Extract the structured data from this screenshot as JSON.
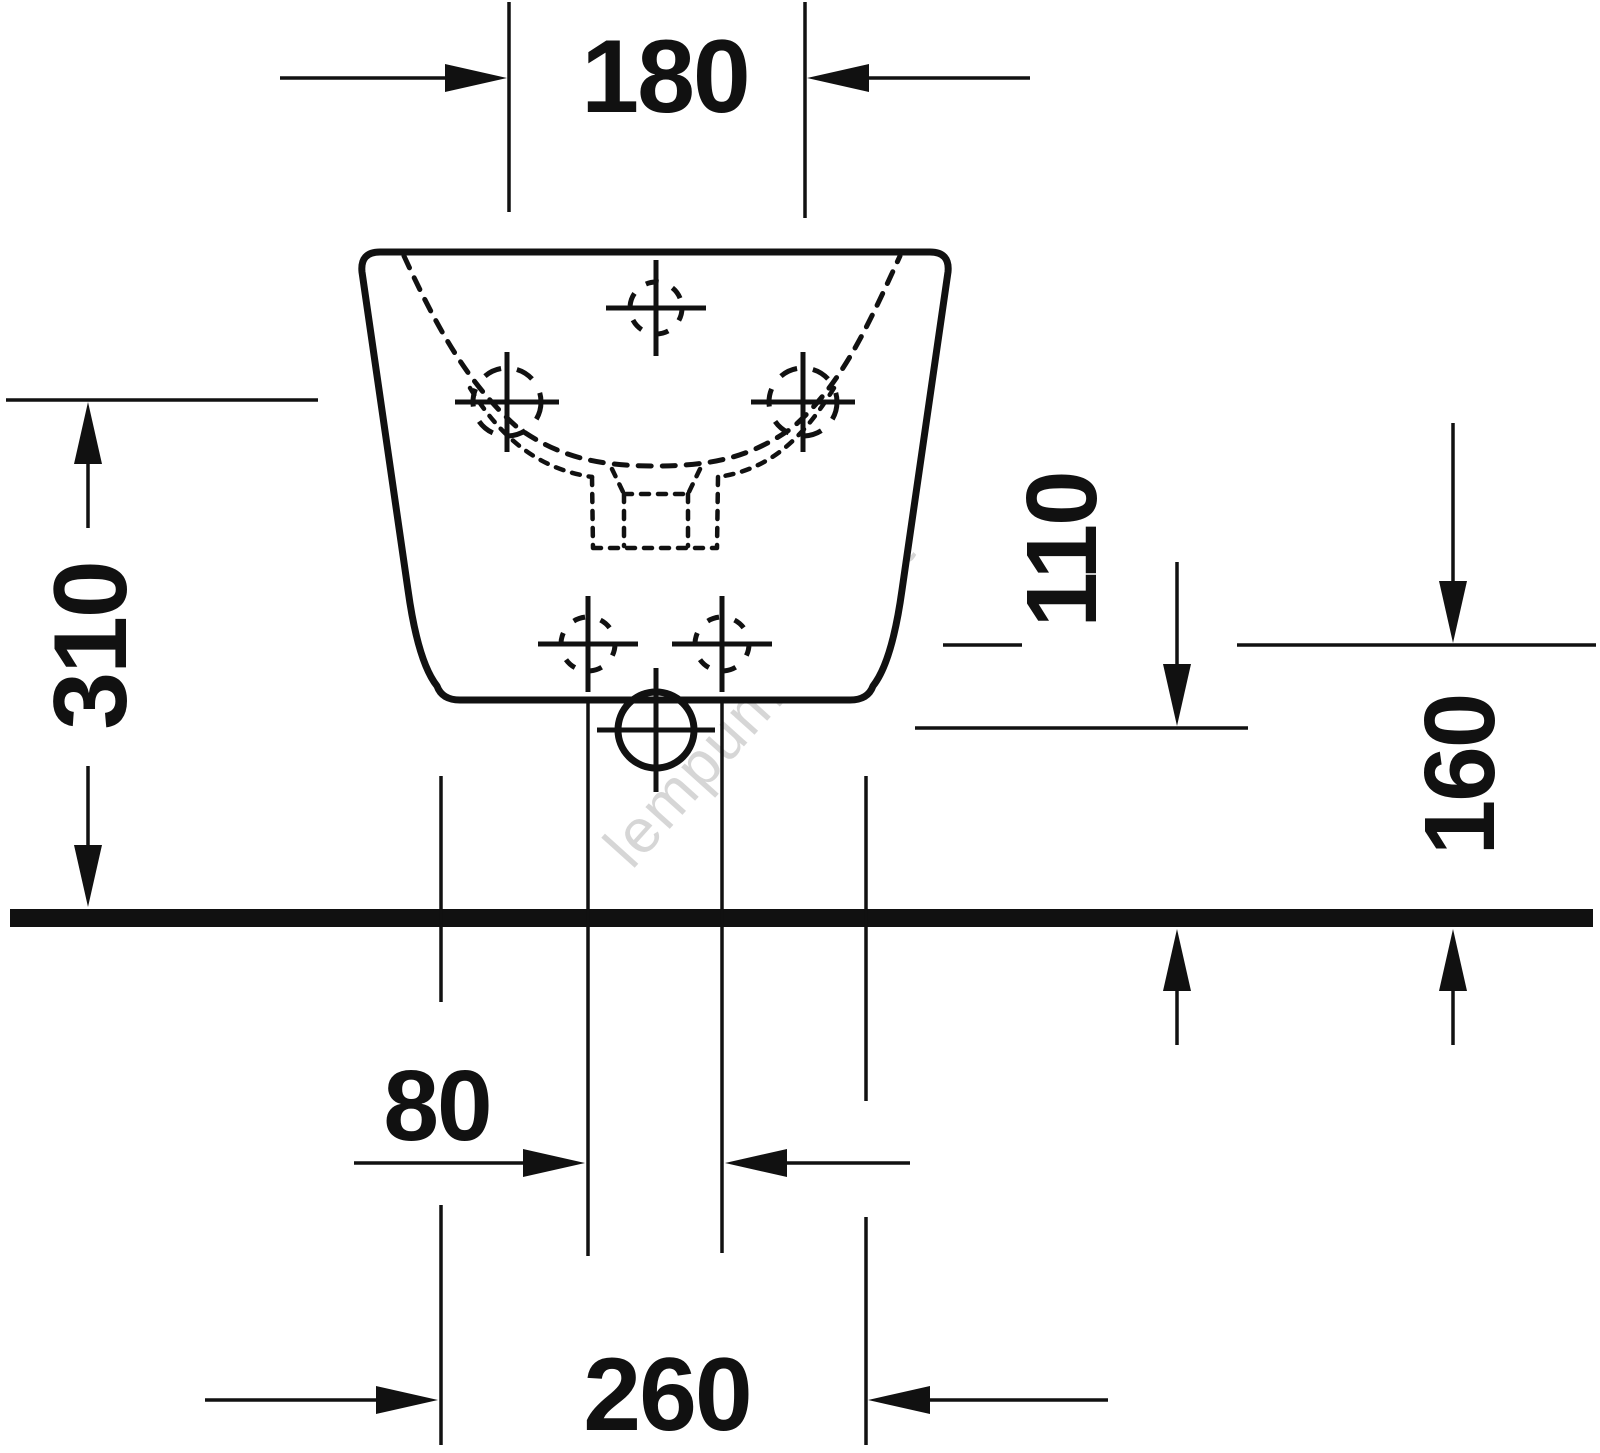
{
  "drawing": {
    "dimensions": {
      "d180": "180",
      "d310": "310",
      "d110": "110",
      "d160": "160",
      "d80": "80",
      "d260": "260"
    },
    "watermark": "lempumanija.lt",
    "colors": {
      "ink": "#111111",
      "background": "#ffffff",
      "watermark": "rgba(0,0,0,0.16)"
    }
  }
}
